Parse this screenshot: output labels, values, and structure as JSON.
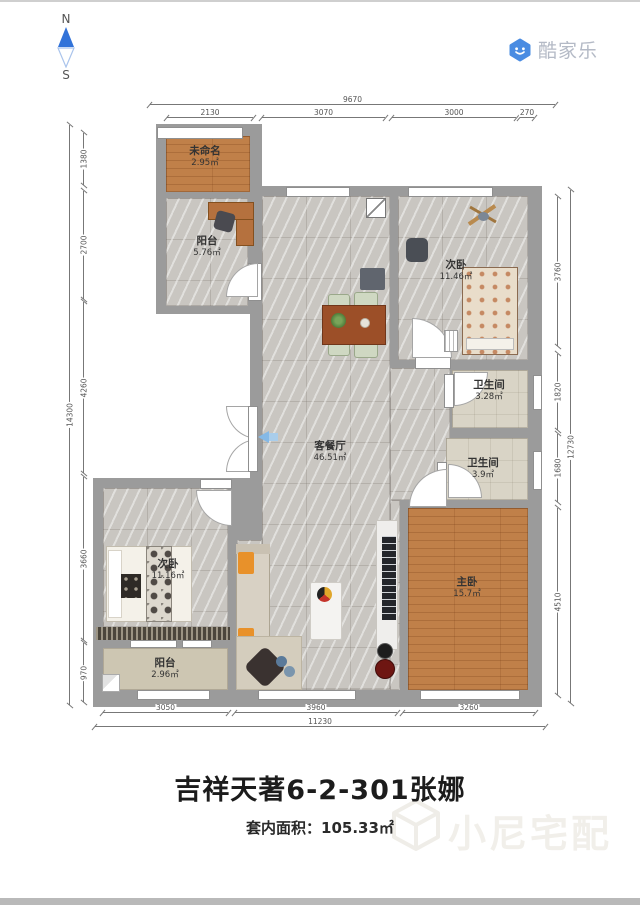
{
  "compass": {
    "north": "N",
    "south": "S"
  },
  "logo": {
    "brand": "酷家乐"
  },
  "rooms": [
    {
      "name": "未命名",
      "area": "2.95㎡"
    },
    {
      "name": "阳台",
      "area": "5.76㎡"
    },
    {
      "name": "次卧",
      "area": "11.46㎡"
    },
    {
      "name": "客餐厅",
      "area": "46.51㎡"
    },
    {
      "name": "卫生间",
      "area": "3.28㎡"
    },
    {
      "name": "卫生间",
      "area": "3.9㎡"
    },
    {
      "name": "主卧",
      "area": "15.7㎡"
    },
    {
      "name": "次卧",
      "area": "11.16㎡"
    },
    {
      "name": "阳台",
      "area": "2.96㎡"
    }
  ],
  "dims": {
    "top_total": "9670",
    "top_segments": [
      "2130",
      "3070",
      "3000",
      "270"
    ],
    "left_total": "14300",
    "left_segments": [
      "1380",
      "2700",
      "4260",
      "3660",
      "970"
    ],
    "right_total": "12730",
    "right_segments": [
      "3760",
      "1820",
      "1680",
      "4510"
    ],
    "bottom_total": "11230",
    "bottom_segments": [
      "3050",
      "3960",
      "3260"
    ]
  },
  "footer": {
    "title": "吉祥天著6-2-301张娜",
    "area_line": "套内面积：105.33㎡"
  },
  "watermark": {
    "text": "小尼宅配"
  },
  "colors": {
    "brand_blue": "#4a8ce2",
    "compass_blue": "#3273d9",
    "wall_gray": "#9b9b9b",
    "marble_floor": "#c9c6c1",
    "wood_floor": "#c08049",
    "bath_floor": "#d9d4c6",
    "balcony_floor": "#cdc6b2",
    "sofa_pillow_orange": "#e8912a"
  }
}
